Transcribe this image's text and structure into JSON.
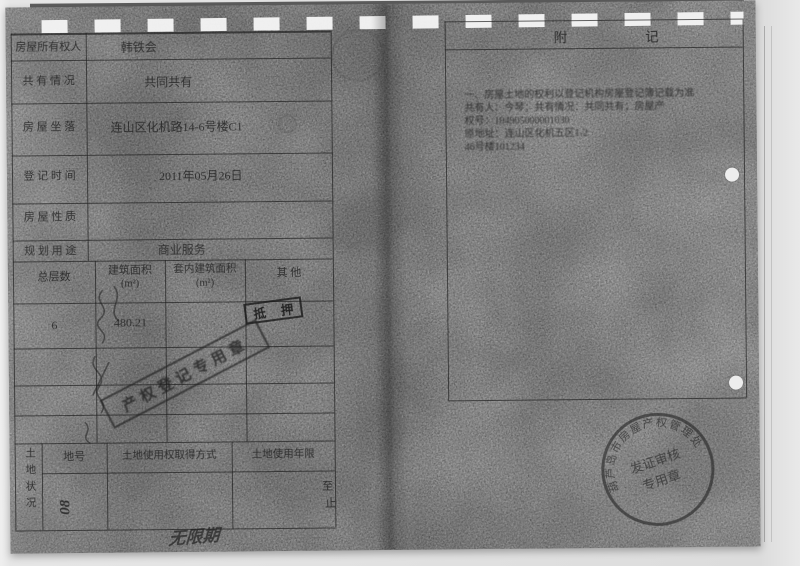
{
  "page": {
    "left": {
      "info_rows": [
        {
          "label": "房屋所有权人",
          "value": "韩铁会"
        },
        {
          "label": "共 有 情 况",
          "value": "共同共有"
        },
        {
          "label": "房 屋 坐 落",
          "value": "连山区化机路14-6号楼C1"
        },
        {
          "label": "登 记 时 间",
          "value": "2011年05月26日"
        },
        {
          "label": "房 屋 性 质",
          "value": ""
        },
        {
          "label": "规 划 用 途",
          "value": "商业服务"
        }
      ],
      "building_table": {
        "headers": [
          "总层数",
          "建筑面积",
          "套内建筑面积",
          "其  他"
        ],
        "unit": "(m²)",
        "values": {
          "floors": "6",
          "area": "480.21"
        }
      },
      "stamps": {
        "mortgage": "抵 押",
        "registration": "产权登记专用章"
      },
      "land": {
        "side_label": "土地状况",
        "headers": [
          "地号",
          "土地使用权取得方式",
          "土地使用年限"
        ],
        "plot_note": "08",
        "term_from": "至",
        "term_to": "止",
        "handwritten_term": "无限期"
      }
    },
    "right": {
      "title": "附记",
      "note_lines": [
        "一、房屋土地的权利以登记机构房屋登记簿记载为准",
        "共有人：今琴；共有情况：共同共有；房屋产",
        "权号：104905000001030",
        "原地址：连山区化机五区1-2",
        "46号楼101234"
      ],
      "seal": {
        "ring_text": "葫芦岛市房屋产权管理处",
        "center_line1": "发证审核",
        "center_line2": "专用章"
      }
    }
  }
}
